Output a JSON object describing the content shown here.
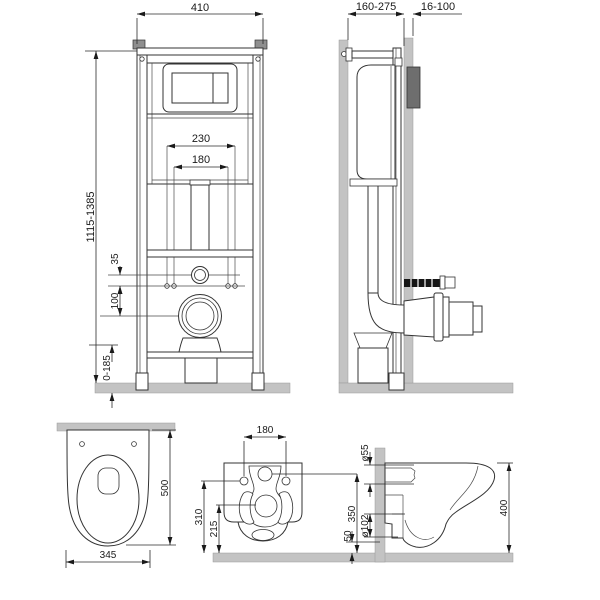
{
  "drawing_title": "Wall-hung toilet installation frame - dimensional drawing",
  "frame_front": {
    "width": "410",
    "height_range": "1115-1385",
    "rod_spacing_outer": "230",
    "rod_spacing_inner": "180",
    "inlet_to_rods": "35",
    "rods_to_outlet": "100",
    "leg_adjust_range": "0-185"
  },
  "frame_side": {
    "frame_depth_range": "160-275",
    "panel_thickness_range": "16-100"
  },
  "bowl_top": {
    "depth": "500",
    "width": "345"
  },
  "bowl_rear": {
    "hole_spacing": "180",
    "hole_height": "310",
    "outlet_height": "215",
    "inlet_height": "350"
  },
  "bowl_side": {
    "inlet_diameter": "ø55",
    "outlet_diameter": "ø102",
    "outlet_floor_gap": "50",
    "bowl_height": "400"
  },
  "colors": {
    "line": "#333333",
    "dim_text": "#1a1a1a",
    "wall_gray": "#bdbdbd",
    "panel_dark": "#6e6e6e",
    "rod_black": "#161616",
    "background": "#ffffff"
  }
}
